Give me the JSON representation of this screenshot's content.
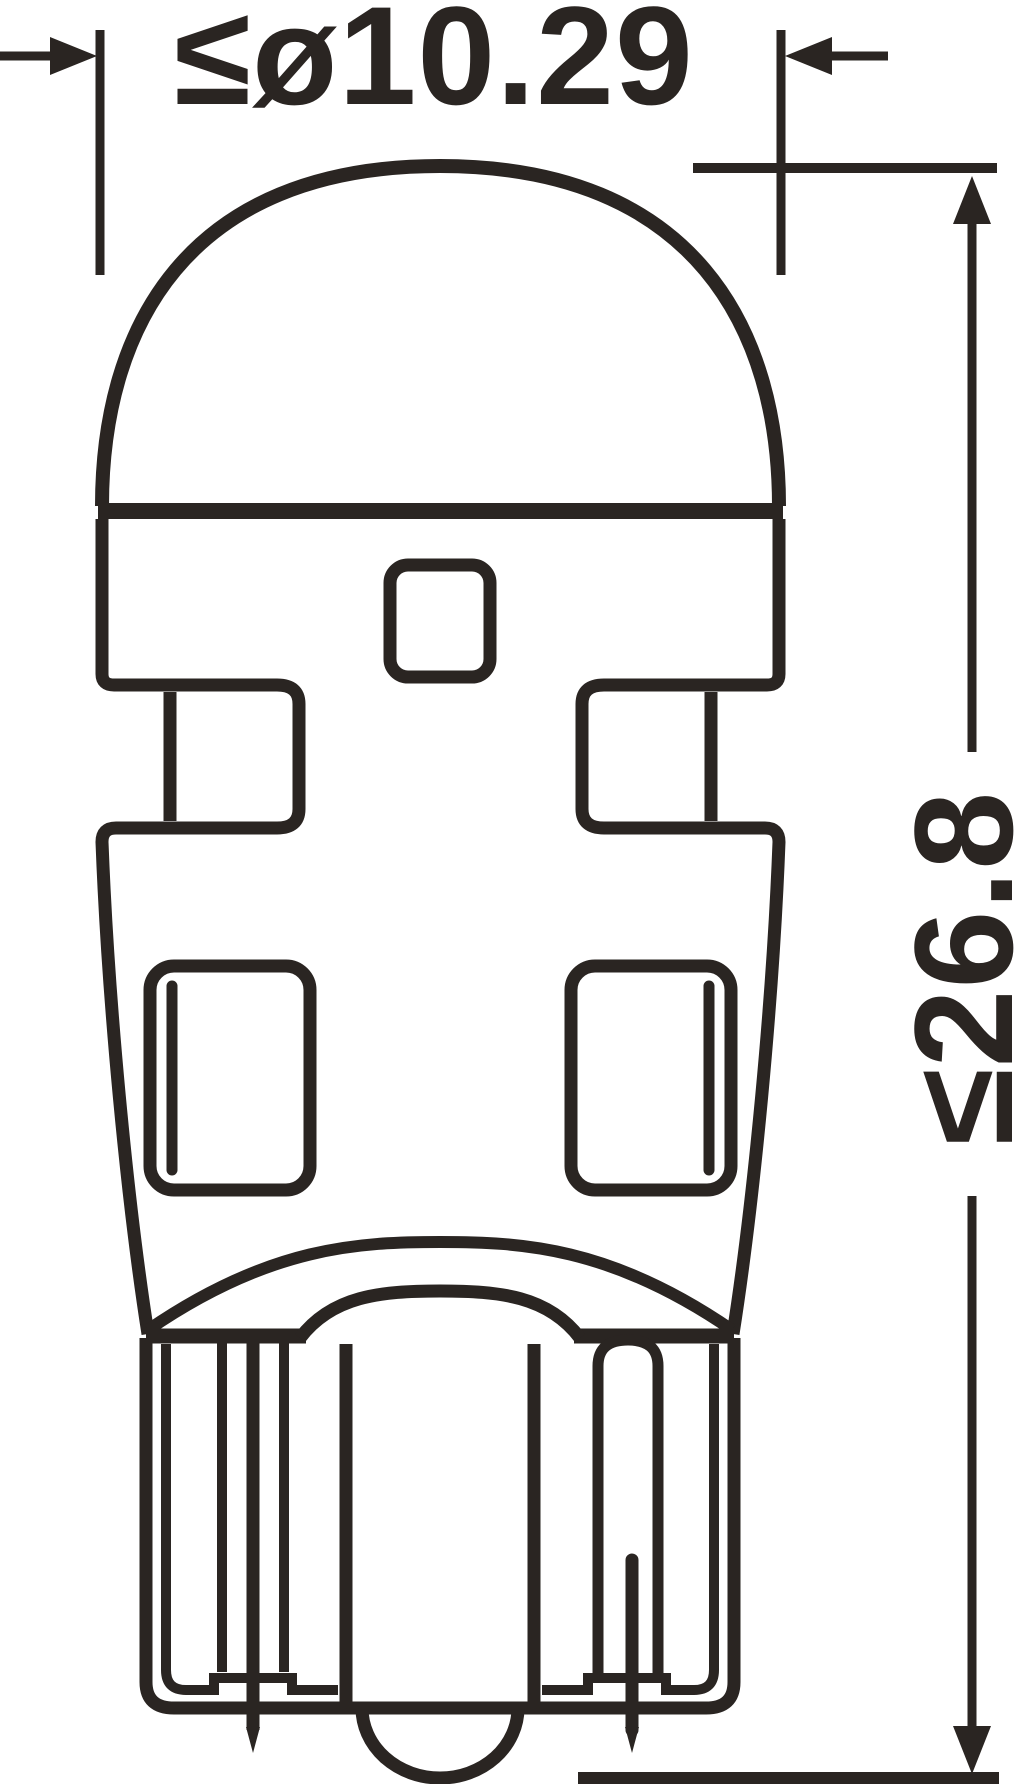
{
  "drawing": {
    "type": "technical-dimension-drawing",
    "subject": "wedge-base-led-bulb-side-view",
    "dimensions": {
      "diameter": {
        "label": "≤ø10.29",
        "value": 10.29,
        "constraint": "max"
      },
      "height": {
        "label": "≤26.8",
        "value": 26.8,
        "constraint": "max"
      }
    },
    "colors": {
      "ink": "#2a2522",
      "background": "#ffffff"
    }
  }
}
